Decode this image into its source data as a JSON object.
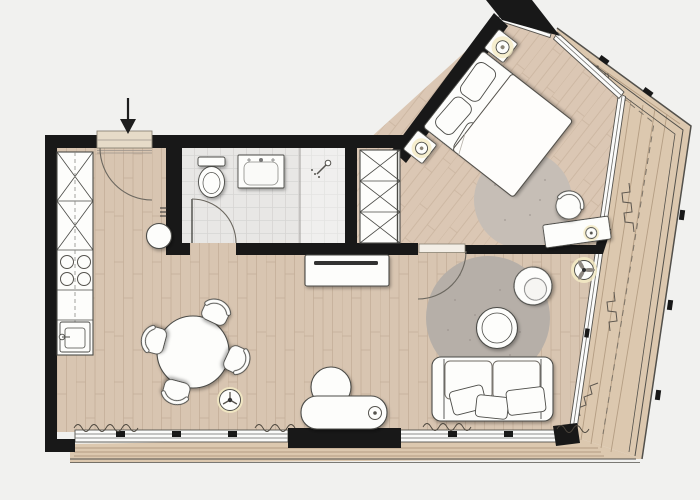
{
  "title": "Apartment floor plan",
  "colors": {
    "background": "#f1f1ef",
    "wall": "#181818",
    "floor": "#d8c5b1",
    "floor_line": "#c2ac96",
    "tile": "#e8e7e5",
    "tile_line": "#d6d5d3",
    "deck": "#dcc8af",
    "deck_line": "#b49d83",
    "railing": "#52504b",
    "furniture": "#fdfdfb",
    "furniture_line": "#4b4b47",
    "glass": "#fbfbfa",
    "glass_line": "#6b6b68",
    "rug_living": "#b6afa8",
    "rug_bedroom": "#c6beb6",
    "lamp_glow": "#f5ebc6",
    "door_leaf": "#e6dbc8",
    "plant": "#5c564e",
    "arrow": "#1d1d1d"
  },
  "rooms": [
    {
      "id": "entrance-hall",
      "label": "Entrance hall"
    },
    {
      "id": "bathroom",
      "label": "Bathroom"
    },
    {
      "id": "kitchen",
      "label": "Kitchen"
    },
    {
      "id": "living-dining-area",
      "label": "Living / dining area"
    },
    {
      "id": "bedroom",
      "label": "Bedroom"
    },
    {
      "id": "balcony-terrace",
      "label": "Balcony terrace"
    }
  ],
  "furniture": [
    {
      "id": "kitchen-wall-unit",
      "label": "Kitchen unit with tall cabinets",
      "room": "kitchen"
    },
    {
      "id": "cooktop",
      "label": "Cooktop with 4 burners",
      "room": "kitchen"
    },
    {
      "id": "kitchen-sink",
      "label": "Kitchen sink",
      "room": "kitchen"
    },
    {
      "id": "hall-stool",
      "label": "Stool",
      "room": "entrance-hall"
    },
    {
      "id": "toilet",
      "label": "Toilet",
      "room": "bathroom"
    },
    {
      "id": "washbasin",
      "label": "Washbasin",
      "room": "bathroom"
    },
    {
      "id": "shower",
      "label": "Shower",
      "room": "bathroom"
    },
    {
      "id": "dining-table",
      "label": "Round dining table with 4 chairs",
      "room": "living-dining-area"
    },
    {
      "id": "floor-lamp",
      "label": "Floor lamp",
      "room": "living-dining-area"
    },
    {
      "id": "tv-sideboard",
      "label": "TV sideboard",
      "room": "living-dining-area"
    },
    {
      "id": "sofa",
      "label": "Sofa with pillows",
      "room": "living-dining-area"
    },
    {
      "id": "coffee-table",
      "label": "Round coffee table",
      "room": "living-dining-area"
    },
    {
      "id": "living-rug",
      "label": "Round rug",
      "room": "living-dining-area"
    },
    {
      "id": "armchair",
      "label": "Armchair",
      "room": "living-dining-area"
    },
    {
      "id": "lounge-chair",
      "label": "Lounge chair",
      "room": "living-dining-area"
    },
    {
      "id": "ceiling-fan",
      "label": "Ceiling fan",
      "room": "living-dining-area"
    },
    {
      "id": "double-bed",
      "label": "Double bed",
      "room": "bedroom"
    },
    {
      "id": "nightstand-left",
      "label": "Nightstand with lamp",
      "room": "bedroom"
    },
    {
      "id": "nightstand-right",
      "label": "Nightstand with lamp",
      "room": "bedroom"
    },
    {
      "id": "bedroom-wardrobe",
      "label": "Wardrobe",
      "room": "bedroom"
    },
    {
      "id": "bedroom-rug",
      "label": "Round rug",
      "room": "bedroom"
    },
    {
      "id": "desk",
      "label": "Desk with lamp",
      "room": "bedroom"
    },
    {
      "id": "desk-chair",
      "label": "Desk chair",
      "room": "bedroom"
    },
    {
      "id": "balcony-railing",
      "label": "Balcony railing",
      "room": "balcony-terrace"
    },
    {
      "id": "balcony-plants",
      "label": "Plants",
      "room": "balcony-terrace"
    }
  ],
  "annotations": [
    {
      "id": "entrance-arrow",
      "label": "Entrance",
      "symbol": "↓"
    }
  ]
}
